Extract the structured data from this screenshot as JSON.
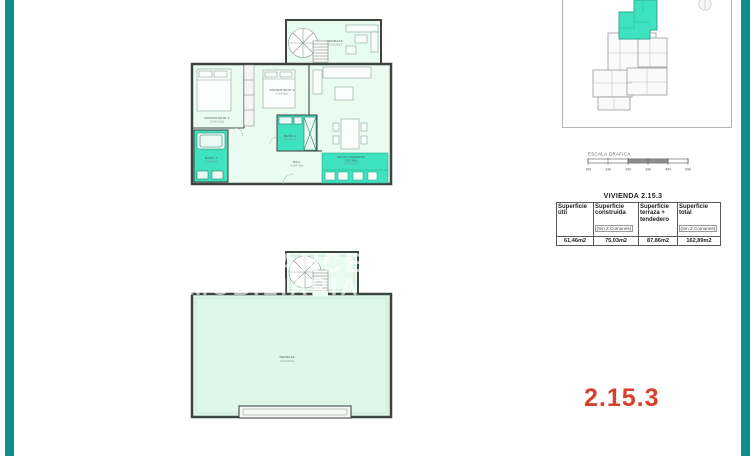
{
  "colors": {
    "teal_bar": "#0f8e8e",
    "highlight": "#3fe2bf",
    "room_fill": "#e9fcf2",
    "terrace_fill": "#ddf7e9",
    "wall": "#3d4440",
    "unit_label_red": "#d6402c"
  },
  "upper_plan": {
    "terraza_roof": {
      "name": "TERRAZA",
      "area": "S.U=13.85m2"
    },
    "dormitorio1": {
      "name": "DORMITORIO 1",
      "area": "S.U=14.01m2"
    },
    "dormitorio2": {
      "name": "DORMITORIO 2",
      "area": "S.U=9.08m2"
    },
    "bano1": {
      "name": "BAÑO 1",
      "area": "S.U=4.44m2"
    },
    "bano2": {
      "name": "BAÑO 2",
      "area": "S.U=4.07m2"
    },
    "hall": {
      "name": "HALL",
      "area": "S.U=4.76m2"
    },
    "salon": {
      "name": "SALON-COMEDOR",
      "name2": "COCINA",
      "area": "S.U=24.24m2"
    }
  },
  "lower_plan": {
    "terraza": {
      "name": "TERRAZA",
      "area": "S.U=74.01m2"
    }
  },
  "scale_bar": {
    "title": "ESCALA GRAFICA",
    "ticks": [
      "0M",
      "1M",
      "2M",
      "3M",
      "4M",
      "5M"
    ]
  },
  "table": {
    "title": "VIVIENDA 2.15.3",
    "columns": [
      {
        "label": "Superficie útil",
        "note": "",
        "value": "61,46m2"
      },
      {
        "label": "Superficie construida",
        "note": "(Sin Z.Comunes)",
        "value": "75,03m2"
      },
      {
        "label": "Superficie terraza + tendedero",
        "note": "",
        "value": "87,86m2"
      },
      {
        "label": "Superficie total",
        "note": "(Sin Z.Comunes)",
        "value": "162,89m2"
      }
    ]
  },
  "unit_label": {
    "text": "2.15.3"
  },
  "watermark": {
    "line1": "AVANCE",
    "line2": "INMOBILIARIA"
  }
}
